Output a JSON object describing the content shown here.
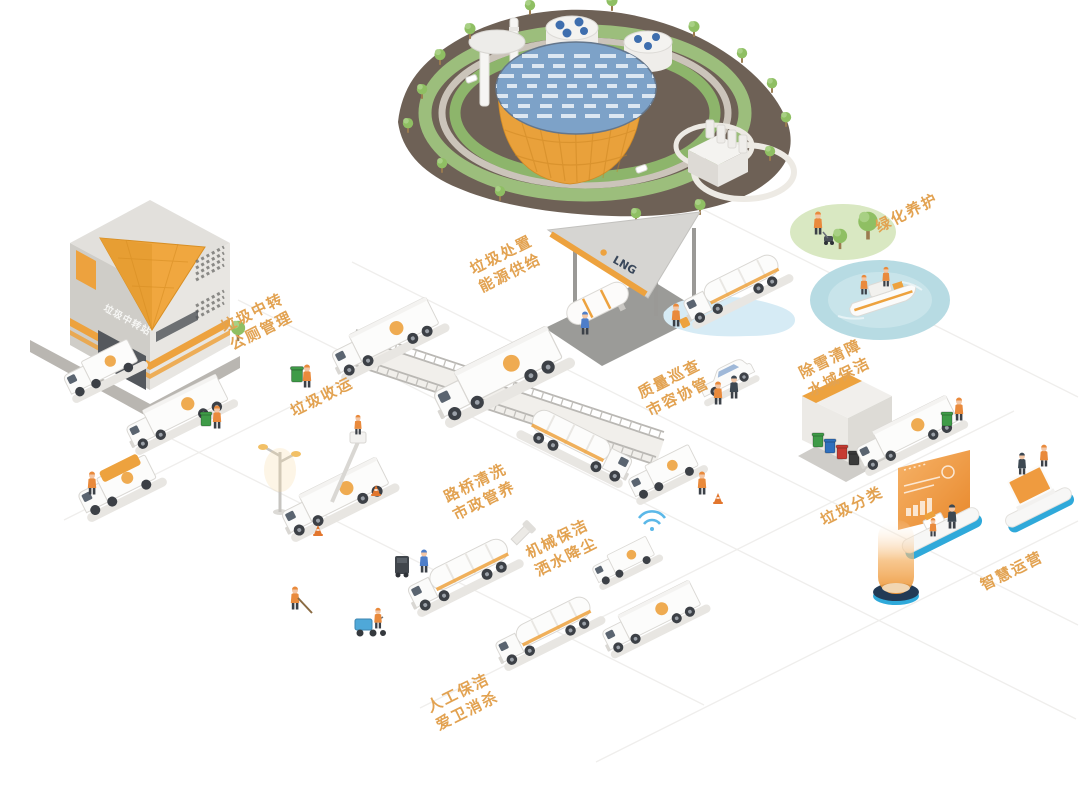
{
  "colors": {
    "background": "#FFFFFF",
    "label_orange": "#E2A251",
    "accent_orange": "#EDA23E",
    "terrain_brown": "#6E6156",
    "lawn_green": "#9CBE7C",
    "solar_roof_blue": "#7DA2C8",
    "water_blue": "#B7DBE3",
    "platform_rim_blue": "#2FA9DA",
    "truck_white": "#FCFCFB",
    "bin_green": "#3F9B48",
    "bin_blue": "#2F6FBD",
    "bin_red": "#C63B32",
    "bin_black": "#3A3A3A"
  },
  "signs": {
    "transfer_station": "垃圾中转站",
    "lng_station": "LNG"
  },
  "labels": {
    "transfer": {
      "line1": "垃圾中转",
      "line2": "公厕管理"
    },
    "disposal": {
      "line1": "垃圾处置",
      "line2": "能源供给"
    },
    "collection": {
      "line1": "垃圾收运",
      "line2": ""
    },
    "road_bridge": {
      "line1": "路桥清洗",
      "line2": "市政管养"
    },
    "mechanical": {
      "line1": "机械保洁",
      "line2": "洒水降尘"
    },
    "manual": {
      "line1": "人工保洁",
      "line2": "爱卫消杀"
    },
    "greening": {
      "line1": "绿化养护",
      "line2": ""
    },
    "snow_water": {
      "line1": "除雪清障",
      "line2": "水域保洁"
    },
    "quality": {
      "line1": "质量巡查",
      "line2": "市容协管"
    },
    "sorting": {
      "line1": "垃圾分类",
      "line2": ""
    },
    "smart_ops": {
      "line1": "智慧运营",
      "line2": ""
    }
  }
}
